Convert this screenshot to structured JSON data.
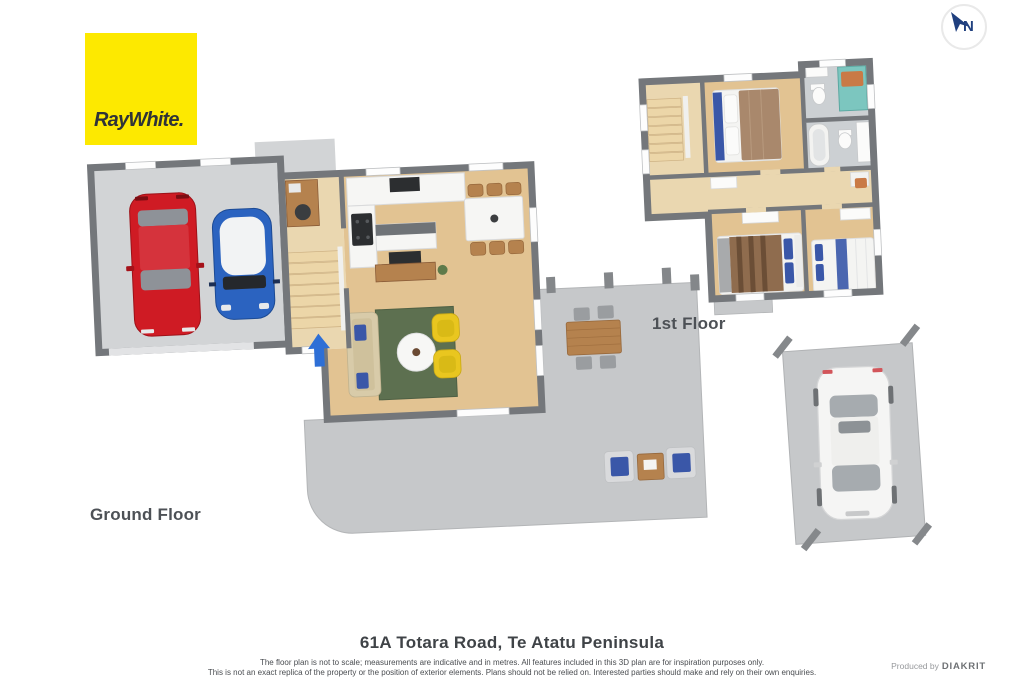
{
  "brand": {
    "logo_text": "RayWhite."
  },
  "compass": {
    "label": "N"
  },
  "floors": {
    "ground_label": "Ground Floor",
    "first_label": "1st Floor"
  },
  "footer": {
    "address": "61A Totara Road, Te Atatu Peninsula",
    "disclaimer_line1": "The floor plan is not to scale; measurements are indicative and in metres. All features included in this 3D plan are for inspiration purposes only.",
    "disclaimer_line2": "This is not an exact replica of the property or the position of exterior elements. Plans should not be relied on. Interested parties should make and rely on their own enquiries.",
    "produced_by_label": "Produced by",
    "producer_name": "DIAKRIT"
  },
  "colors": {
    "brand-yellow": "#fde900",
    "brand-text": "#2f3338",
    "compass-blue": "#20407f",
    "label-gray": "#4d5156",
    "disclaimer-gray": "#4a4d51",
    "wall-dark": "#74777b",
    "floor-wood": "#e2c392",
    "floor-wood-light": "#ead7b0",
    "floor-concrete": "#d2d4d6",
    "patio-concrete": "#c6c8ca",
    "tile-gray": "#ccd0d3",
    "rug-green": "#5d7050",
    "sofa-beige": "#d8cba9",
    "chair-yellow": "#e9c61f",
    "car-red": "#cf1b24",
    "car-blue": "#2b63c0",
    "car-white": "#f5f5f4",
    "accent-blue": "#2e6fd6",
    "bed-brown": "#a9886c",
    "bed-stripe-brown": "#8f6c4e",
    "pillow-navy": "#3a57a8",
    "teal-shower": "#7cc6bf",
    "towel-orange": "#c97a46",
    "counter-white": "#f6f6f4",
    "island-gray": "#6f7377",
    "table-wood": "#b5824e",
    "tv-black": "#2c2e30"
  }
}
